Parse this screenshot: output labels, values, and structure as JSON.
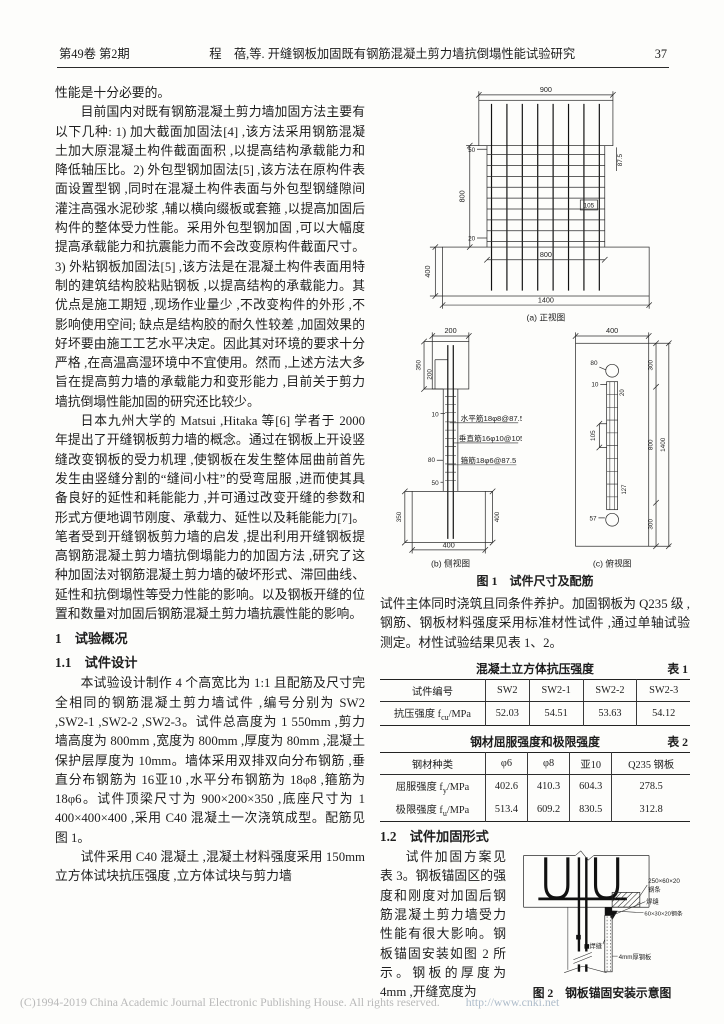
{
  "header": {
    "issue": "第49卷 第2期",
    "title": "程　蓓,等. 开缝钢板加固既有钢筋混凝土剪力墙抗倒塌性能试验研究",
    "page_no": "37"
  },
  "left": {
    "p1": "性能是十分必要的。",
    "p2": "目前国内对既有钢筋混凝土剪力墙加固方法主要有以下几种: 1) 加大截面加固法[4] ,该方法采用钢筋混凝土加大原混凝土构件截面面积 ,以提高结构承载能力和降低轴压比。2) 外包型钢加固法[5] ,该方法在原构件表面设置型钢 ,同时在混凝土构件表面与外包型钢缝隙间灌注高强水泥砂浆 ,辅以横向缀板或套箍 ,以提高加固后构件的整体受力性能。采用外包型钢加固 ,可以大幅度提高承载能力和抗震能力而不会改变原构件截面尺寸。3) 外粘钢板加固法[5] ,该方法是在混凝土构件表面用特制的建筑结构胶粘贴钢板 ,以提高结构的承载能力。其优点是施工期短 ,现场作业量少 ,不改变构件的外形 ,不影响使用空间; 缺点是结构胶的耐久性较差 ,加固效果的好坏要由施工工艺水平决定。因此其对环境的要求十分严格 ,在高温高湿环境中不宜使用。然而 ,上述方法大多旨在提高剪力墙的承载能力和变形能力 ,目前关于剪力墙抗倒塌性能加固的研究还比较少。",
    "p3": "日本九州大学的 Matsui ,Hitaka 等[6] 学者于 2000 年提出了开缝钢板剪力墙的概念。通过在钢板上开设竖缝改变钢板的受力机理 ,使钢板在发生整体屈曲前首先发生由竖缝分割的“缝间小柱”的受弯屈服 ,进而使其具备良好的延性和耗能能力 ,并可通过改变开缝的参数和形式方便地调节刚度、承载力、延性以及耗能能力[7]。笔者受到开缝钢板剪力墙的启发 ,提出利用开缝钢板提高钢筋混凝土剪力墙抗倒塌能力的加固方法 ,研究了这种加固法对钢筋混凝土剪力墙的破坏形式、滞回曲线、延性和抗倒塌性等受力性能的影响。以及钢板开缝的位置和数量对加固后钢筋混凝土剪力墙抗震性能的影响。",
    "h1": "1　试验概况",
    "h11": "1.1　试件设计",
    "p4": "本试验设计制作 4 个高宽比为 1:1 且配筋及尺寸完全相同的钢筋混凝土剪力墙试件 ,编号分别为 SW2 ,SW2-1 ,SW2-2 ,SW2-3。试件总高度为 1 550mm ,剪力墙高度为 800mm ,宽度为 800mm ,厚度为 80mm ,混凝土保护层厚度为 10mm。墙体采用双排双向分布钢筋 ,垂直分布钢筋为 16亚10 ,水平分布钢筋为 18φ8 ,箍筋为 18φ6。试件顶梁尺寸为 900×200×350 ,底座尺寸为 1 400×400×400 ,采用 C40 混凝土一次浇筑成型。配筋见图 1。",
    "p5": "试件采用 C40 混凝土 ,混凝土材料强度采用 150mm 立方体试块抗压强度 ,立方体试块与剪力墙"
  },
  "right": {
    "fig1": {
      "caption": "图 1　试件尺寸及配筋",
      "a": {
        "cap": "(a) 正视图",
        "d900": "900",
        "d50": "50",
        "d875": "87.5",
        "d105": "105",
        "d800v": "800",
        "d20": "20",
        "d400": "400",
        "d800b": "800",
        "d1400": "1400"
      },
      "b": {
        "cap": "(b) 侧视图",
        "d200t": "200",
        "d350t": "350",
        "d200i": "200",
        "d10": "10",
        "horiz": "水平筋18φ8@87.5",
        "vert": "垂直筋16φ10@105",
        "d80": "80",
        "stir": "箍筋18φ6@87.5",
        "d50": "50",
        "d350b": "350",
        "d400r": "400",
        "d400b": "400"
      },
      "c": {
        "cap": "(c) 俯视图",
        "d400": "400",
        "d300t": "300",
        "d80": "80",
        "d10": "10",
        "d20": "20",
        "d105": "105",
        "d800": "800",
        "d1400": "1400",
        "d127": "127",
        "d57": "57",
        "d300b": "300"
      }
    },
    "p1": "试件主体同时浇筑且同条件养护。加固钢板为 Q235 级 ,钢筋、钢板材料强度采用标准材性试件 ,通过单轴试验测定。材性试验结果见表 1、2。",
    "table1": {
      "title": "混凝土立方体抗压强度",
      "tag": "表 1",
      "header": [
        "试件编号",
        "SW2",
        "SW2-1",
        "SW2-2",
        "SW2-3"
      ],
      "row1_label": {
        "pre": "抗压强度 f",
        "sub": "cu",
        "post": "/MPa"
      },
      "row1": [
        "52.03",
        "54.51",
        "53.63",
        "54.12"
      ]
    },
    "table2": {
      "title": "钢材屈服强度和极限强度",
      "tag": "表 2",
      "header": [
        "钢材种类",
        "φ6",
        "φ8",
        "亚10",
        "Q235 钢板"
      ],
      "row1_label": {
        "pre": "屈服强度 f",
        "sub": "y",
        "post": "/MPa"
      },
      "row1": [
        "402.6",
        "410.3",
        "604.3",
        "278.5"
      ],
      "row2_label": {
        "pre": "极限强度 f",
        "sub": "u",
        "post": "/MPa"
      },
      "row2": [
        "513.4",
        "609.2",
        "830.5",
        "312.8"
      ]
    },
    "h12": "1.2　试件加固形式",
    "p2": "试件加固方案见表 3。钢板锚固区的强度和刚度对加固后钢筋混凝土剪力墙受力性能有很大影响。钢板锚固安装如图 2 所示。钢板的厚度为 4mm ,开缝宽度为",
    "fig2": {
      "caption": "图 2　钢板锚固安装示意图",
      "strip1a": "250×60×20",
      "strip1b": "钢条",
      "weld1": "焊缝",
      "strip2": "60×30×20钢条",
      "weld2": "焊缝",
      "plate": "4mm厚钢板"
    }
  },
  "footer": {
    "copyright": "(C)1994-2019 China Academic Journal Electronic Publishing House. All rights reserved.",
    "url": "http://www.cnki.net"
  }
}
